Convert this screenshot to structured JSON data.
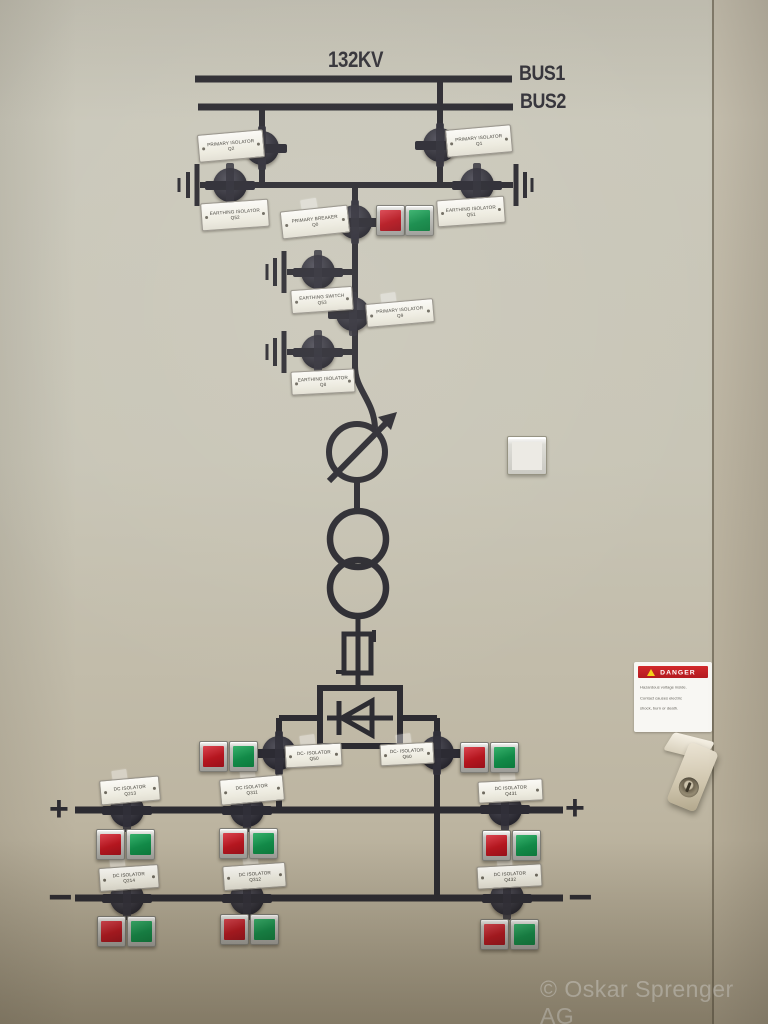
{
  "header": {
    "voltage": "132KV",
    "bus1": "BUS1",
    "bus2": "BUS2"
  },
  "polarity": {
    "plus": "+",
    "minus": "−"
  },
  "plates": [
    {
      "id": "Q2",
      "line1": "PRIMARY ISOLATOR",
      "line2": "Q2"
    },
    {
      "id": "Q1",
      "line1": "PRIMARY ISOLATOR",
      "line2": "Q1"
    },
    {
      "id": "Q52",
      "line1": "EARTHING ISOLATOR",
      "line2": "Q52"
    },
    {
      "id": "Q0",
      "line1": "PRIMARY BREAKER",
      "line2": "Q0"
    },
    {
      "id": "Q51",
      "line1": "EARTHING ISOLATOR",
      "line2": "Q51"
    },
    {
      "id": "Q53",
      "line1": "EARTHING SWITCH",
      "line2": "Q53"
    },
    {
      "id": "Q9",
      "line1": "PRIMARY ISOLATOR",
      "line2": "Q9"
    },
    {
      "id": "Q8",
      "line1": "EARTHING ISOLATOR",
      "line2": "Q8"
    },
    {
      "id": "Q50",
      "line1": "DC- ISOLATOR",
      "line2": "Q50"
    },
    {
      "id": "Q60",
      "line1": "DC- ISOLATOR",
      "line2": "Q60"
    },
    {
      "id": "Q213",
      "line1": "DC ISOLATOR",
      "line2": "Q213"
    },
    {
      "id": "Q311",
      "line1": "DC ISOLATOR",
      "line2": "Q311"
    },
    {
      "id": "Q431",
      "line1": "DC ISOLATOR",
      "line2": "Q431"
    },
    {
      "id": "Q214",
      "line1": "DC ISOLATOR",
      "line2": "Q214"
    },
    {
      "id": "Q312",
      "line1": "DC ISOLATOR",
      "line2": "Q312"
    },
    {
      "id": "Q432",
      "line1": "DC ISOLATOR",
      "line2": "Q432"
    }
  ],
  "sticker": {
    "header": "DANGER",
    "line1": "Hazardous voltage inside.",
    "line2": "Contact causes electric",
    "line3": "shock, burn or death."
  },
  "watermark": "© Oskar Sprenger AG",
  "colors": {
    "panel": "#c8c5b6",
    "line": "#2c2b31",
    "button_red": "#b5161f",
    "button_green": "#128a48",
    "plate": "#f4f3ee",
    "danger_red": "#c42127",
    "warning_yellow": "#f4cf1b"
  }
}
